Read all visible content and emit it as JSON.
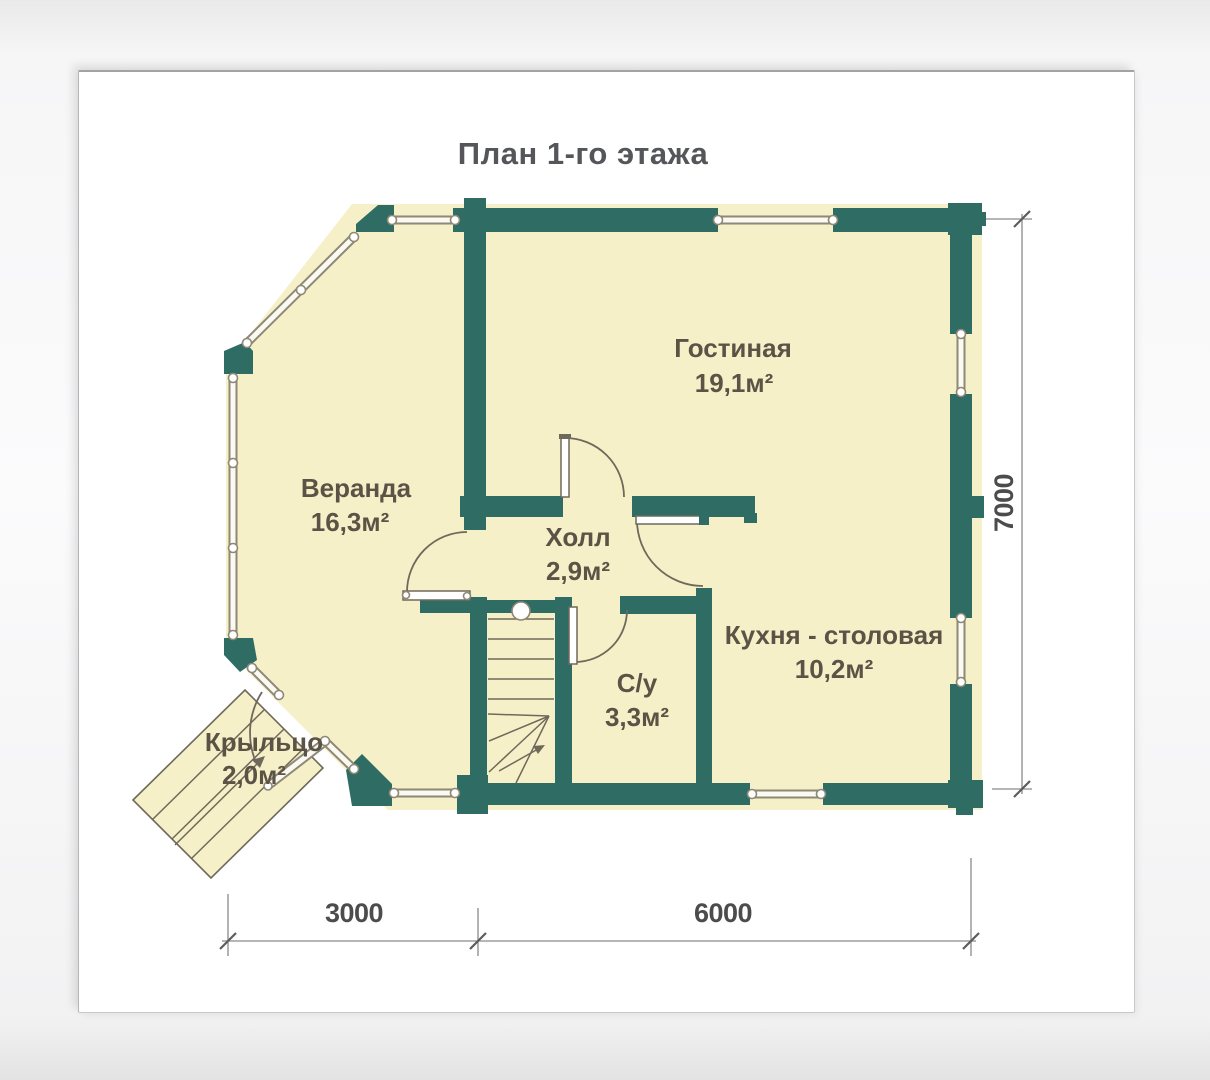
{
  "title": "План 1-го этажа",
  "rooms": [
    {
      "name": "Гостиная",
      "area": "19,1м²"
    },
    {
      "name": "Веранда",
      "area": "16,3м²"
    },
    {
      "name": "Холл",
      "area": "2,9м²"
    },
    {
      "name": "С/у",
      "area": "3,3м²"
    },
    {
      "name": "Кухня - столовая",
      "area": "10,2м²"
    },
    {
      "name": "Крыльцо",
      "area": "2,0м²"
    }
  ],
  "dimensions": {
    "bottom_left": "3000",
    "bottom_right": "6000",
    "right": "7000"
  },
  "colors": {
    "wall": "#2e6c64",
    "floor": "#f6f0c8",
    "thinwall": "#8e8876",
    "line": "#6f695c",
    "dim": "#8a8a8a",
    "dimtext": "#4c4c4c",
    "label": "#5a5346",
    "title": "#55565a",
    "card": "#ffffff"
  }
}
